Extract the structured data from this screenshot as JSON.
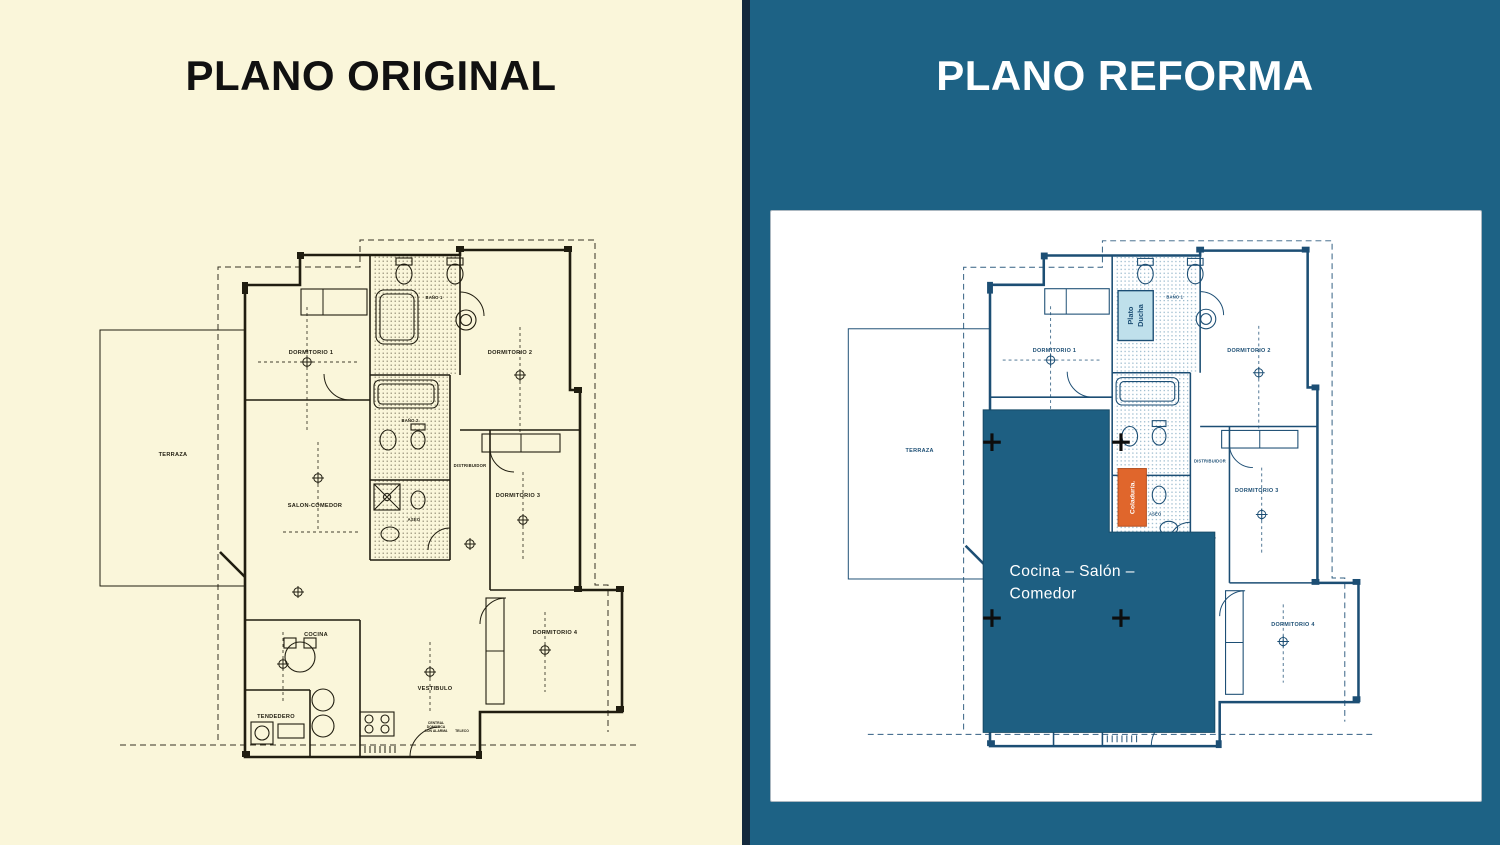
{
  "left_panel": {
    "title": "PLANO ORIGINAL"
  },
  "right_panel": {
    "title": "PLANO REFORMA"
  },
  "rooms": {
    "terraza": "TERRAZA",
    "dormitorio1": "DORMITORIO 1",
    "dormitorio2": "DORMITORIO 2",
    "dormitorio3": "DORMITORIO 3",
    "dormitorio4": "DORMITORIO 4",
    "bano1": "BAÑO 1",
    "bano2": "BAÑO 2",
    "aseo": "ASEO",
    "distribuidor": "DISTRIBUIDOR",
    "salon_comedor": "SALON-COMEDOR",
    "cocina": "COCINA",
    "tendedero": "TENDEDERO",
    "vestibulo": "VESTIBULO",
    "central_domotica_1": "CENTRAL",
    "central_domotica_2": "DOMOTICA",
    "central_domotica_3": "CON ALARMA",
    "teleco": "TELECO"
  },
  "reform_overlays": {
    "plato_ducha_line1": "Plato",
    "plato_ducha_line2": "Ducha",
    "coladuria": "Coladuría.",
    "cocina_salon_line1": "Cocina – Salón –",
    "cocina_salon_line2": "Comedor"
  },
  "colors": {
    "left_background": "#FAF6DA",
    "right_background": "#1D6285",
    "divider": "#13293C",
    "card_background": "#FFFFFF",
    "original_line": "#201D10",
    "reform_line": "#1C4E74",
    "overlay_teal": "#1E5F82",
    "overlay_orange": "#E0662C",
    "plato_ducha_fill": "#BFE0EB",
    "crosshair": "#0D0D0D",
    "title_left": "#111111",
    "title_right": "#FFFFFF"
  }
}
